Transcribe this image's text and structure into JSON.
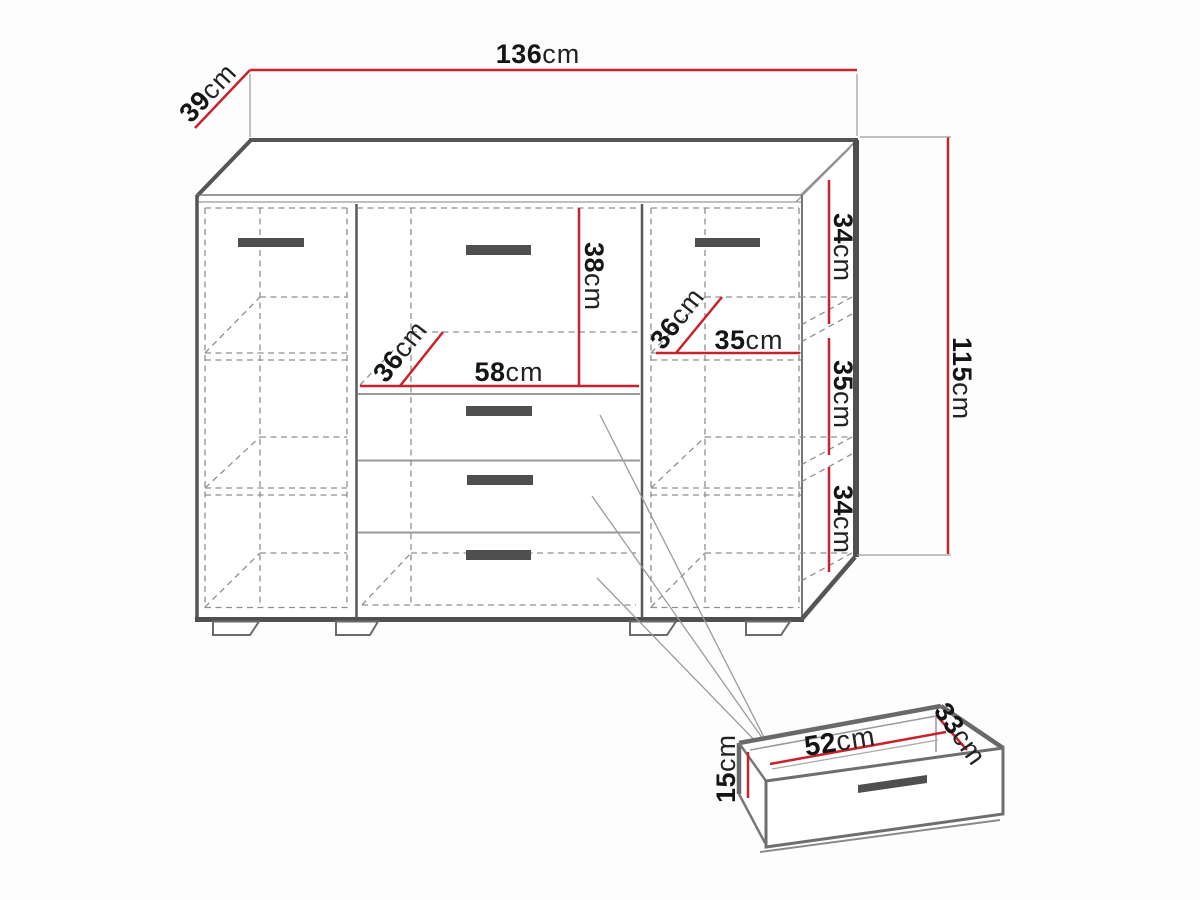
{
  "colors": {
    "dimension_line": "#c8232b",
    "structure_dark": "#4f4f4f",
    "structure_mid": "#777777",
    "dashed_line": "#8f8f8f",
    "handle": "#4f4f4f",
    "label_text": "#151515"
  },
  "dimensions": {
    "total_width": {
      "value": "136",
      "unit": "cm"
    },
    "total_depth": {
      "value": "39",
      "unit": "cm"
    },
    "total_height": {
      "value": "115",
      "unit": "cm"
    },
    "right_top_section_height": {
      "value": "34",
      "unit": "cm"
    },
    "right_middle_section_height": {
      "value": "35",
      "unit": "cm"
    },
    "right_bottom_section_height": {
      "value": "34",
      "unit": "cm"
    },
    "top_drawer_height": {
      "value": "38",
      "unit": "cm"
    },
    "center_section_width": {
      "value": "58",
      "unit": "cm"
    },
    "center_section_depth": {
      "value": "36",
      "unit": "cm"
    },
    "right_shelf_depth": {
      "value": "36",
      "unit": "cm"
    },
    "right_shelf_width": {
      "value": "35",
      "unit": "cm"
    },
    "drawer_inner_width": {
      "value": "52",
      "unit": "cm"
    },
    "drawer_inner_depth": {
      "value": "33",
      "unit": "cm"
    },
    "drawer_front_height": {
      "value": "15",
      "unit": "cm"
    }
  }
}
